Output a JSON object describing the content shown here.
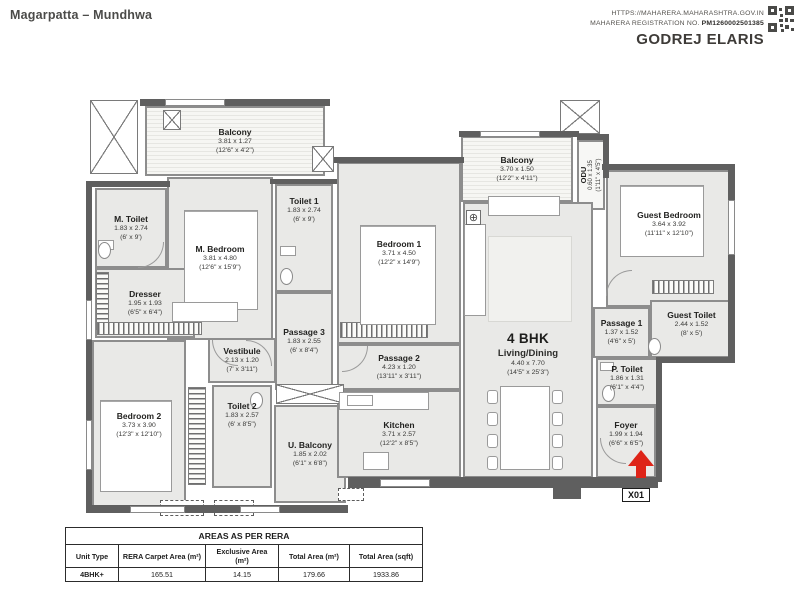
{
  "header": {
    "location": "Magarpatta – Mundhwa",
    "rera_url": "HTTPS://MAHARERA.MAHARASHTRA.GOV.IN",
    "rera_reg_label": "MAHARERA REGISTRATION NO. ",
    "rera_reg_no": "PM1260002501385",
    "brand": "GODREJ ELARIS"
  },
  "plan": {
    "unit_label": "4 BHK",
    "entrance_label": "X01",
    "rooms": [
      {
        "name": "Balcony",
        "dim_m": "3.81 x 1.27",
        "dim_ft": "(12'6\" x 4'2\")"
      },
      {
        "name": "M. Toilet",
        "dim_m": "1.83 x 2.74",
        "dim_ft": "(6' x 9')"
      },
      {
        "name": "M. Bedroom",
        "dim_m": "3.81 x 4.80",
        "dim_ft": "(12'6\" x 15'9\")"
      },
      {
        "name": "Dresser",
        "dim_m": "1.95 x 1.93",
        "dim_ft": "(6'5\" x 6'4\")"
      },
      {
        "name": "Toilet 1",
        "dim_m": "1.83 x 2.74",
        "dim_ft": "(6' x 9')"
      },
      {
        "name": "Bedroom 1",
        "dim_m": "3.71 x 4.50",
        "dim_ft": "(12'2\" x 14'9\")"
      },
      {
        "name": "Balcony",
        "dim_m": "3.70 x 1.50",
        "dim_ft": "(12'2\" x 4'11\")"
      },
      {
        "name": "ODU",
        "dim_m": "0.60 x 1.35",
        "dim_ft": "(1'11\" x 4'5\")"
      },
      {
        "name": "Guest Bedroom",
        "dim_m": "3.64 x 3.92",
        "dim_ft": "(11'11\" x 12'10\")"
      },
      {
        "name": "Passage 3",
        "dim_m": "1.83 x 2.55",
        "dim_ft": "(6' x 8'4\")"
      },
      {
        "name": "Vestibule",
        "dim_m": "2.13 x 1.20",
        "dim_ft": "(7' x 3'11\")"
      },
      {
        "name": "Passage 1",
        "dim_m": "1.37 x 1.52",
        "dim_ft": "(4'6\" x 5')"
      },
      {
        "name": "Guest Toilet",
        "dim_m": "2.44 x 1.52",
        "dim_ft": "(8' x 5')"
      },
      {
        "name": "Living/Dining",
        "dim_m": "4.40 x 7.70",
        "dim_ft": "(14'5\" x 25'3\")"
      },
      {
        "name": "Passage 2",
        "dim_m": "4.23 x 1.20",
        "dim_ft": "(13'11\" x 3'11\")"
      },
      {
        "name": "P. Toilet",
        "dim_m": "1.86 x 1.31",
        "dim_ft": "(6'1\" x 4'4\")"
      },
      {
        "name": "Bedroom 2",
        "dim_m": "3.73 x 3.90",
        "dim_ft": "(12'3\" x 12'10\")"
      },
      {
        "name": "Toilet 2",
        "dim_m": "1.83 x 2.57",
        "dim_ft": "(6' x 8'5\")"
      },
      {
        "name": "U. Balcony",
        "dim_m": "1.85 x 2.02",
        "dim_ft": "(6'1\" x 6'8\")"
      },
      {
        "name": "Kitchen",
        "dim_m": "3.71 x 2.57",
        "dim_ft": "(12'2\" x 8'5\")"
      },
      {
        "name": "Foyer",
        "dim_m": "1.99 x 1.94",
        "dim_ft": "(6'6\" x 6'5\")"
      }
    ]
  },
  "icons": {
    "column_marker": "⊕"
  },
  "table": {
    "title": "AREAS AS PER RERA",
    "columns": [
      "Unit Type",
      "RERA Carpet Area (m²)",
      "Exclusive Area (m²)",
      "Total Area (m²)",
      "Total Area (sqft)"
    ],
    "rows": [
      [
        "4BHK+",
        "165.51",
        "14.15",
        "179.66",
        "1933.86"
      ]
    ]
  },
  "colors": {
    "entrance_arrow": "#de2418",
    "wall": "#5f5f5f",
    "room_fill": "#e9e9e7",
    "text": "#2d2d2b"
  }
}
